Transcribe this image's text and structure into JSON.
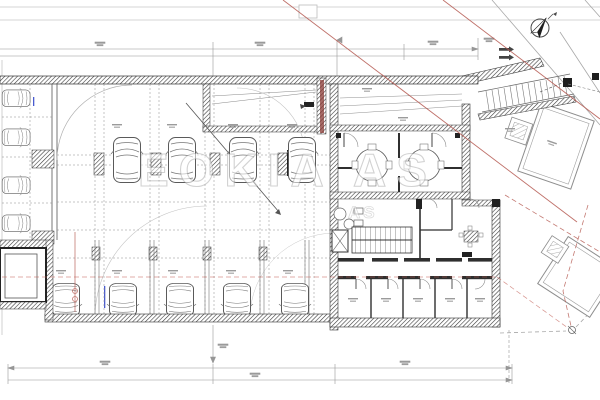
{
  "document": {
    "type": "architectural-floor-plan",
    "view": "basement-parking-level"
  },
  "watermark": {
    "text": "EOKIA AS",
    "subtext": "AS"
  },
  "compass": {
    "icon": "north-arrow-icon"
  },
  "plan": {
    "parking_cars_left_column": 4,
    "parking_cars_top_row": 4,
    "parking_cars_bottom_row": 5,
    "storage_rooms_bottom_row": 5,
    "round_tables": 2,
    "has_stairs": true,
    "has_elevator": true,
    "has_entry_ramp": true,
    "neighbor_buildings": 2
  },
  "colors": {
    "background": "#ffffff",
    "ink": "#4a4a4a",
    "wall_dark": "#2f2f2f",
    "line_light": "#9b9b9b",
    "red_line": "#b4574f",
    "red_dashed": "#c05a52",
    "maroon_wall": "#8a3a34",
    "blue_note": "#4a5bd0"
  }
}
